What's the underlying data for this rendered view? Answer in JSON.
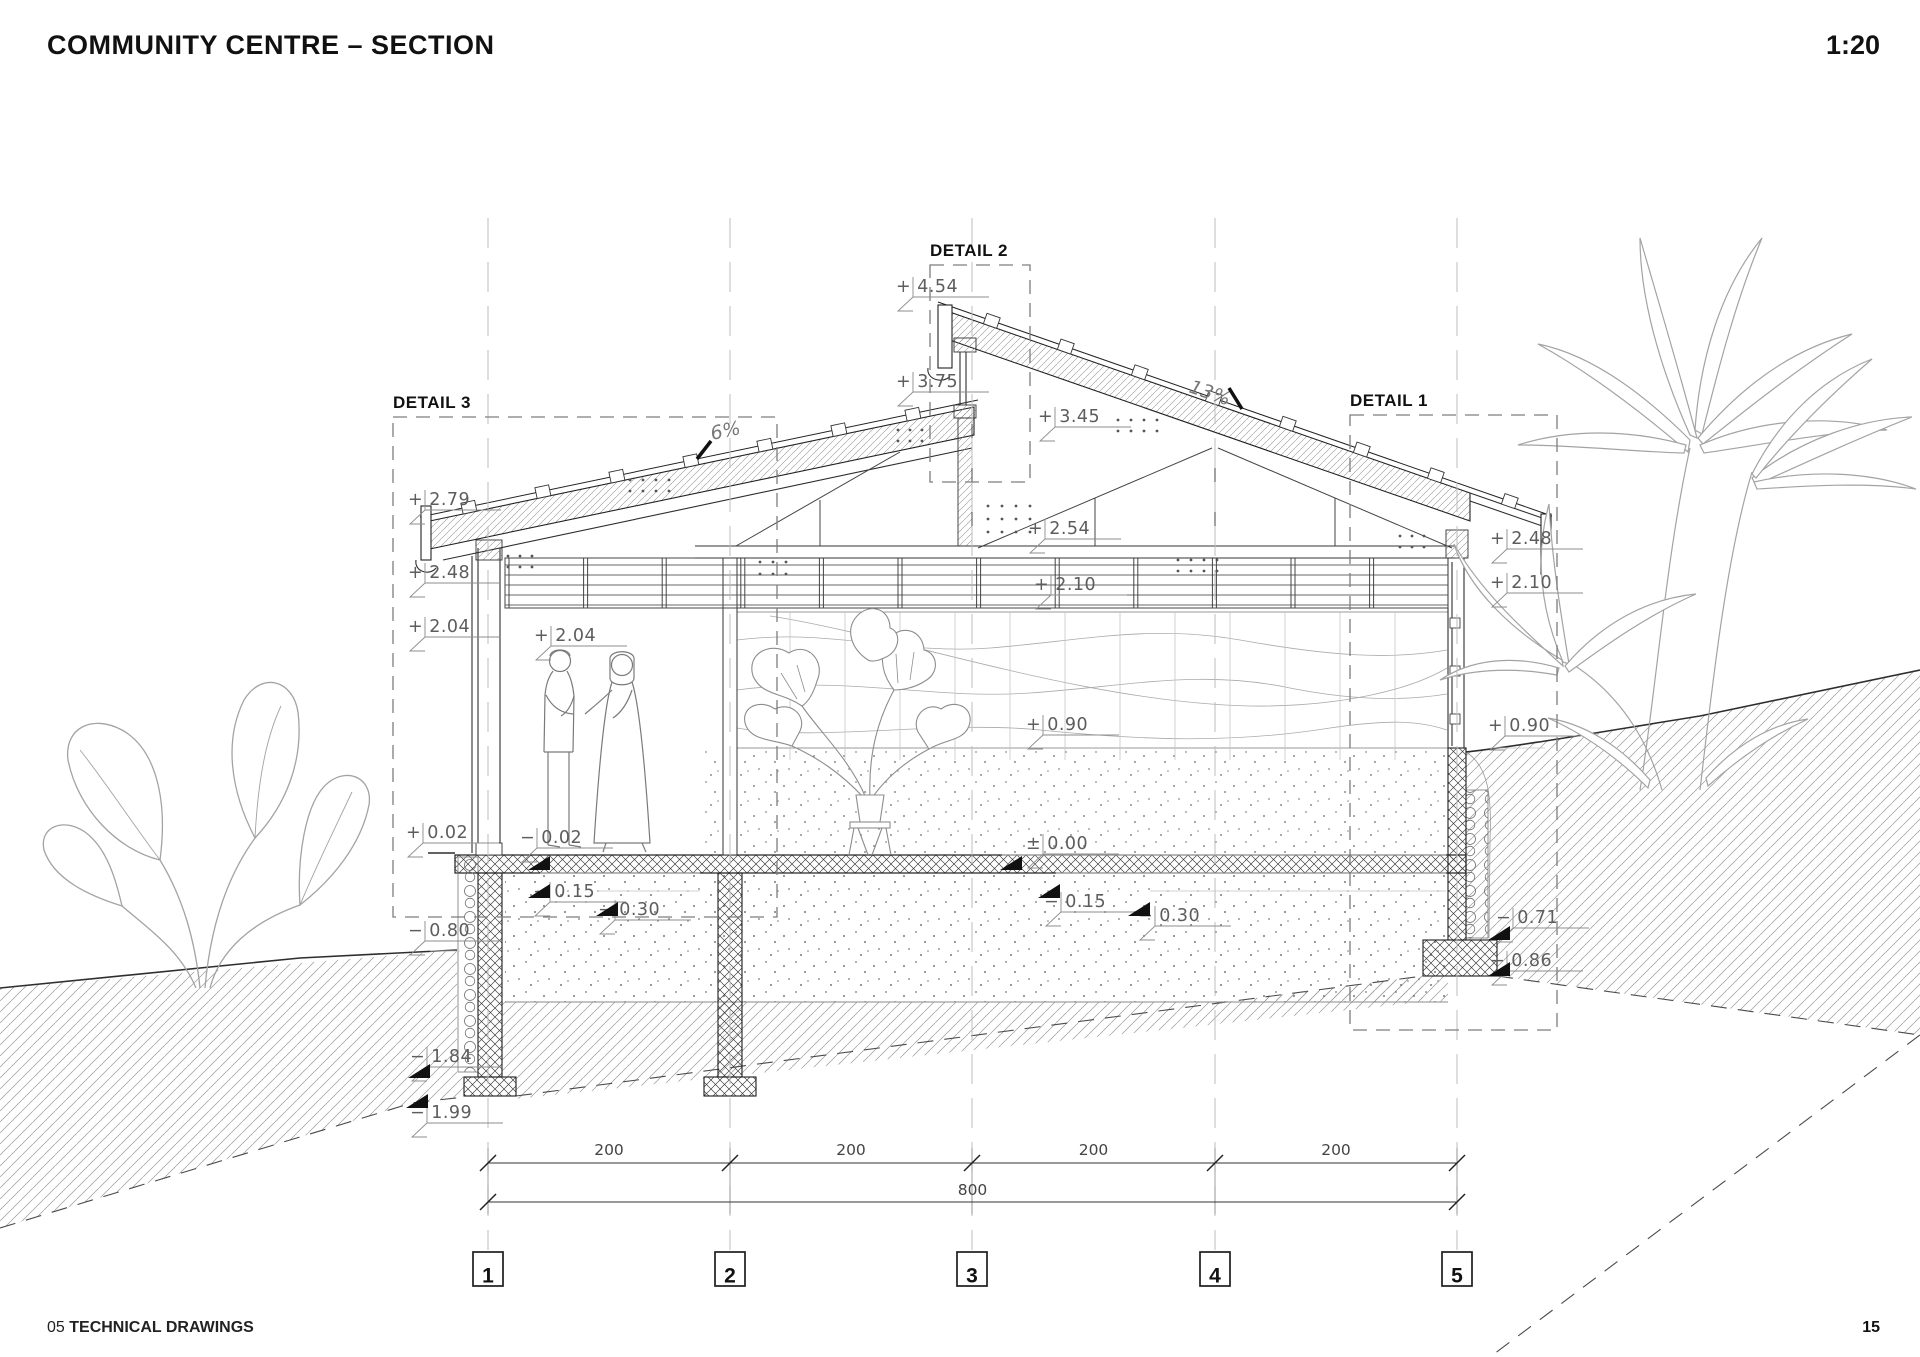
{
  "header": {
    "title": "COMMUNITY CENTRE – SECTION",
    "scale": "1:20"
  },
  "footer": {
    "chapter": "05",
    "chapter_title": "TECHNICAL DRAWINGS",
    "page": "15"
  },
  "drawing": {
    "detail_labels": [
      "DETAIL 3",
      "DETAIL 2",
      "DETAIL 1"
    ],
    "slope_left": "6%",
    "slope_right": "13%",
    "grid_labels": [
      "1",
      "2",
      "3",
      "4",
      "5"
    ],
    "dim_bays": [
      "200",
      "200",
      "200",
      "200"
    ],
    "dim_total": "800",
    "levels": [
      "+ 2.79",
      "+ 2.48",
      "+ 2.04",
      "+ 0.02",
      "− 0.80",
      "− 1.84",
      "− 1.99",
      "+ 2.04",
      "− 0.02",
      "− 0.15",
      "− 0.30",
      "+ 4.54",
      "+ 3.75",
      "+ 3.45",
      "+ 2.54",
      "+ 2.10",
      "± 0.00",
      "− 0.15",
      "− 0.30",
      "+ 0.90",
      "+ 2.48",
      "+ 2.10",
      "+ 0.90",
      "− 0.71",
      "− 0.86"
    ]
  }
}
